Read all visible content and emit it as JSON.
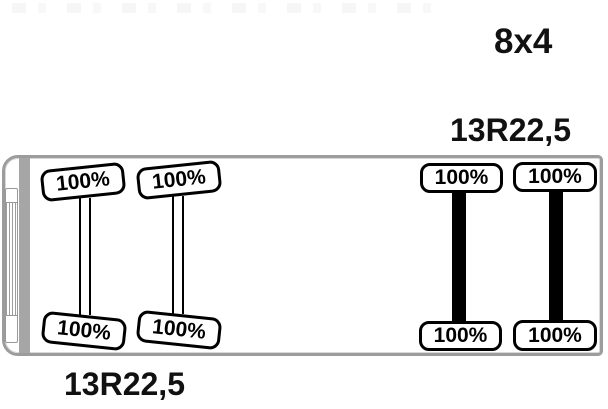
{
  "diagram": {
    "type": "truck-axle-tire-tread-diagram",
    "drive_config": "8x4",
    "front_tire_size": "13R22,5",
    "rear_tire_size": "13R22,5"
  },
  "axles": [
    {
      "name": "front-axle-1",
      "axle_style": "thin-double-line",
      "tires": [
        {
          "side": "top",
          "tread": "100%"
        },
        {
          "side": "bottom",
          "tread": "100%"
        }
      ]
    },
    {
      "name": "front-axle-2",
      "axle_style": "thin-double-line",
      "tires": [
        {
          "side": "top",
          "tread": "100%"
        },
        {
          "side": "bottom",
          "tread": "100%"
        }
      ]
    },
    {
      "name": "rear-axle-1",
      "axle_style": "thick-bar",
      "tires": [
        {
          "side": "top",
          "tread": "100%"
        },
        {
          "side": "bottom",
          "tread": "100%"
        }
      ]
    },
    {
      "name": "rear-axle-2",
      "axle_style": "thick-bar",
      "tires": [
        {
          "side": "top",
          "tread": "100%"
        },
        {
          "side": "bottom",
          "tread": "100%"
        }
      ]
    }
  ],
  "colors": {
    "chassis_border": "#9c9c9c",
    "cab_bar": "#a6a6a6",
    "tire_border": "#000000",
    "axle": "#000000",
    "label_text": "#111111",
    "background": "#ffffff"
  }
}
